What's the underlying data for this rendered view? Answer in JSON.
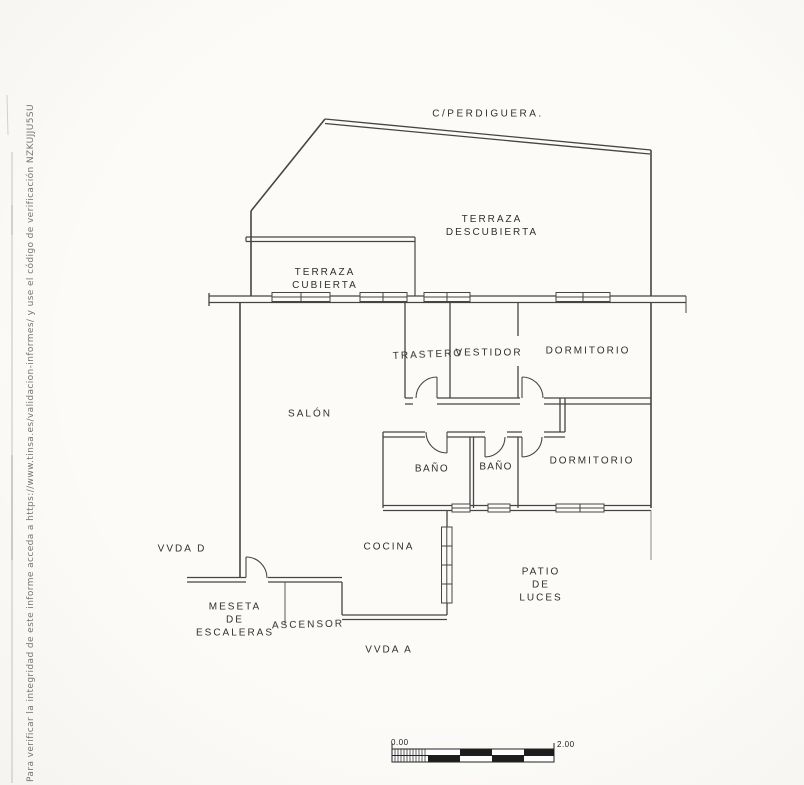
{
  "street_label": "C/PERDIGUERA.",
  "rooms": {
    "terraza_descubierta": "TERRAZA\nDESCUBIERTA",
    "terraza_cubierta": "TERRAZA\nCUBIERTA",
    "trastero": "TRASTERO",
    "vestidor": "VESTIDOR",
    "dormitorio_1": "DORMITORIO",
    "salon": "SALÓN",
    "bano_1": "BAÑO",
    "bano_2": "BAÑO",
    "dormitorio_2": "DORMITORIO",
    "cocina": "COCINA",
    "patio_de_luces": "PATIO\nDE\nLUCES"
  },
  "annotations": {
    "vvda_d": "VVDA D",
    "vvda_a": "VVDA A",
    "meseta_escaleras": "MESETA\nDE\nESCALERAS",
    "ascensor": "ASCENSOR"
  },
  "scale_bar": {
    "left_label": "0.00",
    "right_label": "2.00"
  },
  "watermark": {
    "text": "Para verificar la integridad de este informe acceda a https://www.tinsa.es/validacion-informes/ y use el código de verificación NZKUJJU5SU"
  },
  "colors": {
    "wall_line": "#454545",
    "paper": "#fcfbf8"
  }
}
